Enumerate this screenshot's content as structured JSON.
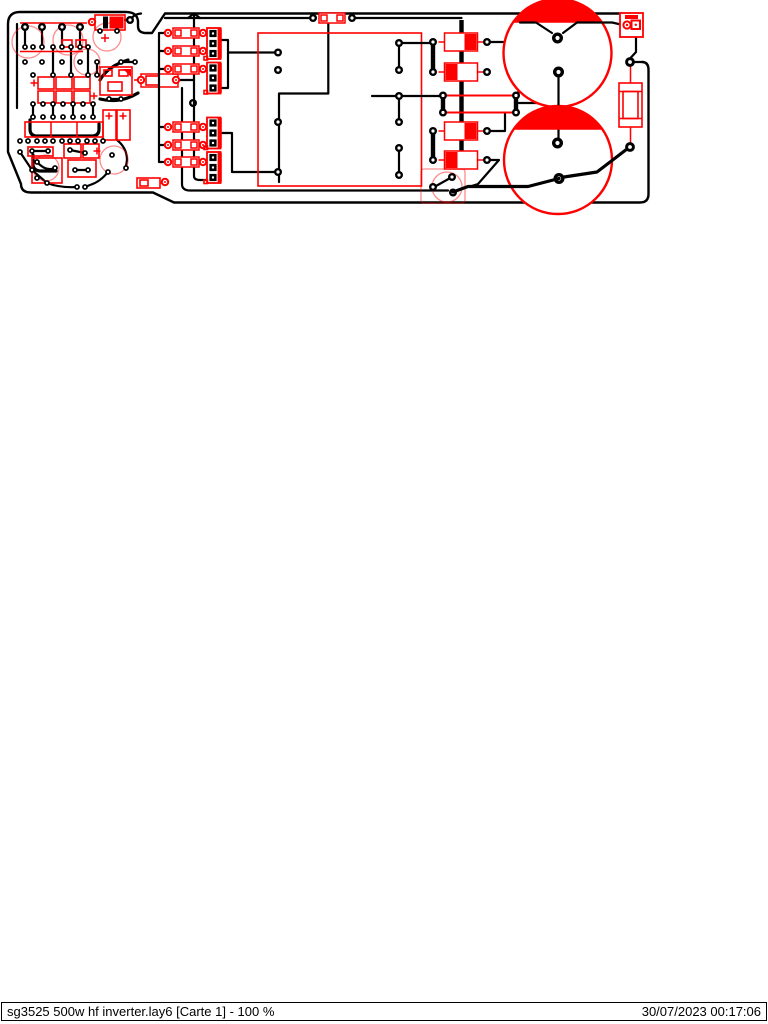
{
  "page": {
    "background": "#ffffff"
  },
  "statusbar": {
    "file_label": "sg3525 500w hf inverter.lay6 [Carte 1] - 100 %",
    "timestamp": "30/07/2023 00:17:06"
  },
  "colors": {
    "copper": "#000000",
    "silkscreen": "#ff0000",
    "page-bg": "#ffffff"
  }
}
